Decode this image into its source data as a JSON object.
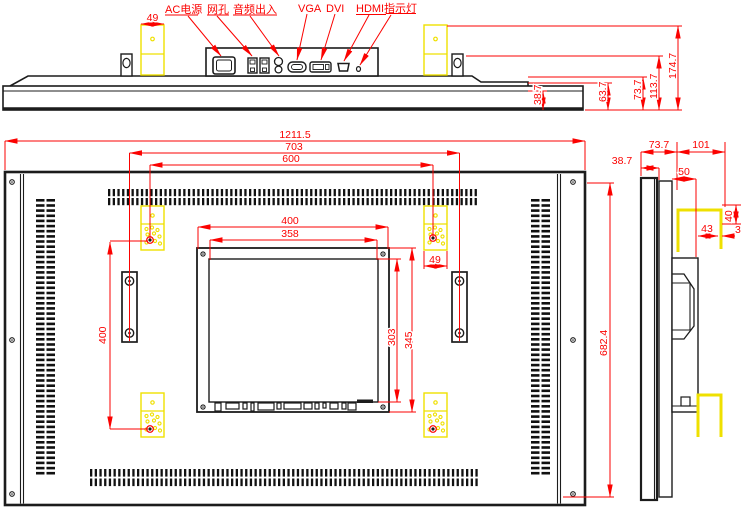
{
  "drawing_type": "monitor-engineering-drawing",
  "colors": {
    "dimension": "#fb0200",
    "outline": "#1c1c1c",
    "bracket": "#efe000",
    "background": "#ffffff"
  },
  "top_view": {
    "port_labels": [
      {
        "label": "AC电源"
      },
      {
        "label": "网孔"
      },
      {
        "label": "音频出入"
      },
      {
        "label": "VGA"
      },
      {
        "label": "DVI"
      },
      {
        "label": "HDMI"
      },
      {
        "label": "指示灯"
      }
    ],
    "dims": {
      "bracket_width": "49",
      "bezel_depth": "38.7",
      "step_depth": "63.7",
      "body_depth": "73.7",
      "hook_top_height": "113.7",
      "bracket_top_height": "174.7"
    }
  },
  "rear_view": {
    "dims": {
      "overall_width": "1211.5",
      "hook_spacing": "703",
      "mount_hole_spacing_h": "600",
      "module_width": "400",
      "opening_width": "358",
      "bracket_width": "49",
      "mount_hole_spacing_v": "400",
      "opening_height": "303",
      "module_height": "345",
      "overall_height": "682.4"
    }
  },
  "side_view": {
    "dims": {
      "body_depth": "73.7",
      "bracket_offset": "101",
      "bezel_depth": "38.7",
      "box_depth": "50",
      "bracket_leg": "40",
      "bracket_width": "43",
      "gap": "3"
    }
  }
}
